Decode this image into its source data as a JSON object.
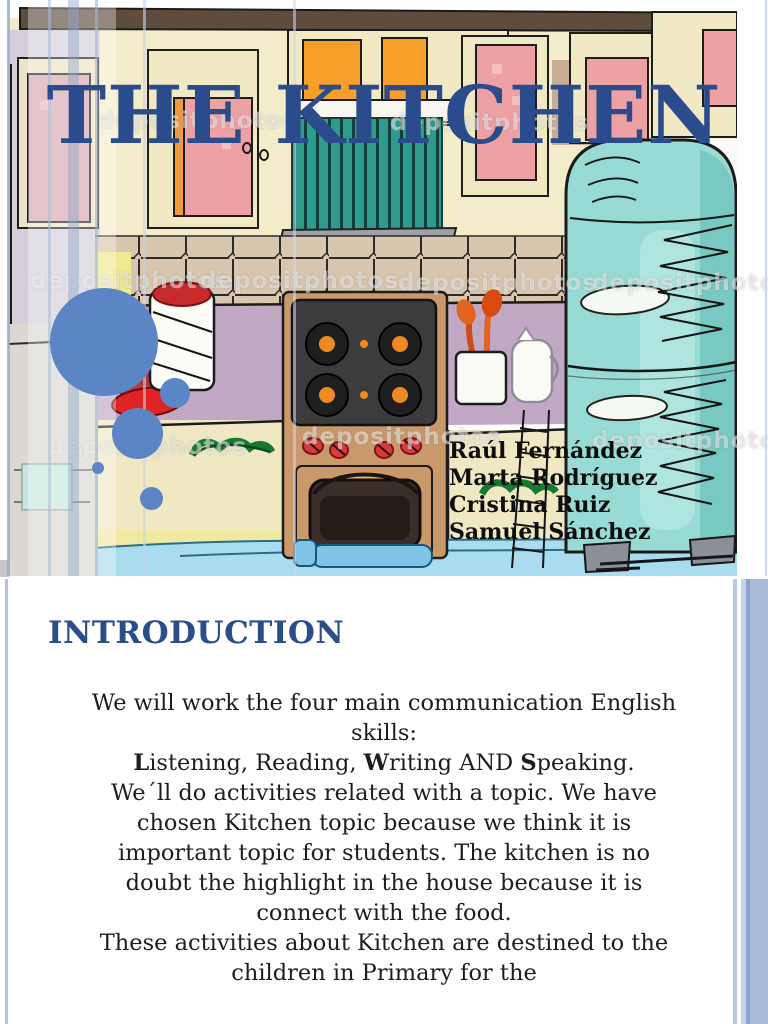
{
  "slide1": {
    "title": "THE KITCHEN",
    "authors": [
      "Raúl Fernández",
      "Marta Rodríguez",
      "Cristina Ruiz",
      "Samuel Sánchez"
    ],
    "vent_label": "06b",
    "watermark": "depositphotos"
  },
  "slide2": {
    "heading": "INTRODUCTION",
    "paragraph1": {
      "lines": [
        "We will work the four main communication English",
        "skills:"
      ]
    },
    "skills": {
      "seg0": "L",
      "seg1": "istening, Reading, ",
      "seg2": "W",
      "seg3": "riting AND ",
      "seg4": "S",
      "seg5": "peaking."
    },
    "paragraph2": {
      "lines": [
        "We´ll do activities related with a topic. We have",
        "chosen Kitchen topic because we think it is",
        "important topic for students. The kitchen is no",
        "doubt the highlight in the house because it is",
        "connect with the food."
      ]
    },
    "paragraph3": {
      "lines": [
        "These activities about Kitchen are destined to the",
        "children in Primary for the"
      ]
    }
  },
  "colors": {
    "title_blue": "#2B4C8C",
    "heading_blue": "#2A4E87",
    "circle_blue": "#5B85C5",
    "stripe_blue": "#A9BCDA",
    "fridge_teal": "#98DBD4",
    "vent_teal": "#2E9C8D",
    "counter_mauve": "#C1A8C5",
    "wall_cream": "#F2ECCA",
    "cabinet_pink": "#EDA1A4",
    "accent_orange": "#F69F2B",
    "floor_blue": "#A9DCEF"
  }
}
